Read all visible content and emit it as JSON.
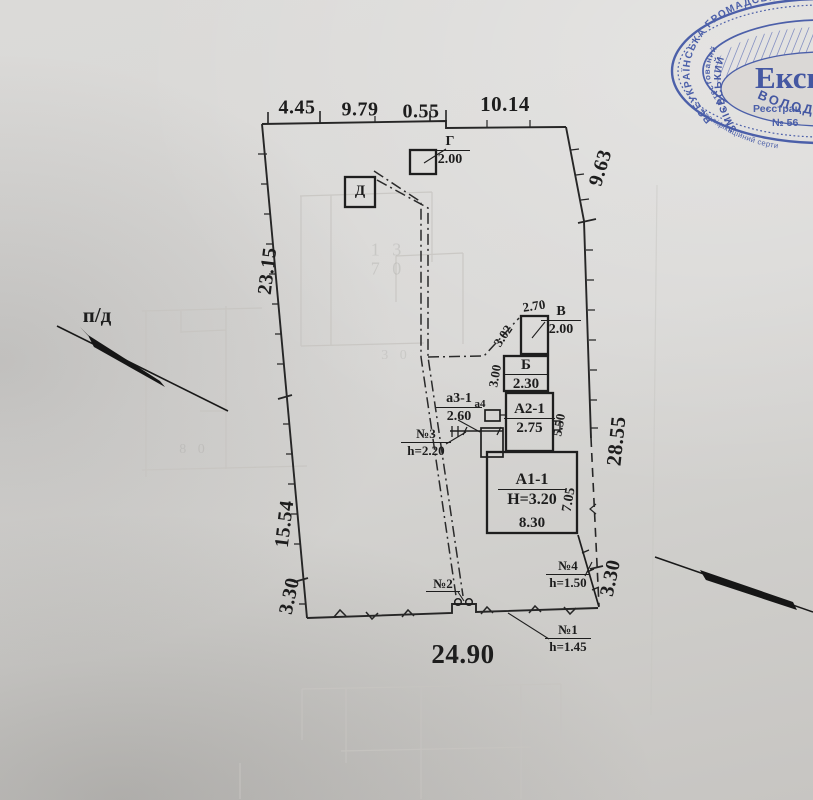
{
  "document": {
    "type_note": "scanned cadastral site plan",
    "ink_color": "#1d1d1d",
    "paper_color": "#d8d7d5"
  },
  "dimensions": {
    "top": [
      "4.45",
      "9.79",
      "0.55",
      "10.14"
    ],
    "left": [
      "23.15",
      "15.54",
      "3.30"
    ],
    "right": [
      "9.63",
      "28.55",
      "3.30"
    ],
    "bottom": "24.90"
  },
  "labels": {
    "direction": "п/д"
  },
  "buildings": {
    "g": {
      "lit": "Г",
      "h": "2.00"
    },
    "d": {
      "lit": "Д"
    },
    "v": {
      "lit": "В",
      "h": "2.00"
    },
    "b": {
      "lit": "Б",
      "h": "2.30"
    },
    "a21": {
      "lit": "А2-1",
      "h": "2.75"
    },
    "a11": {
      "lit": "А1-1",
      "h": "Н=3.20"
    },
    "a31": {
      "lit": "а3-1",
      "h": "2.60"
    },
    "a4": {
      "lit": "а4"
    }
  },
  "sizes": {
    "v_top": "2.70",
    "v_wall": "3.02",
    "b_wall": "3.00",
    "a21_wall": "5.50",
    "a11_wall": "7.05",
    "a11_width": "8.30"
  },
  "fences": {
    "n1": {
      "no": "№1",
      "h": "h=1.45"
    },
    "n2": {
      "no": "№2"
    },
    "n3": {
      "no": "№3",
      "h": "h=2.20"
    },
    "n4": {
      "no": "№4",
      "h": "h=1.50"
    }
  },
  "bleed": {
    "b1": "1 3",
    "b2": "7 0",
    "b3": "3 0",
    "b4": "8 0"
  },
  "stamp": {
    "color": "#3b51a3",
    "name_big": "Експ",
    "reg_label": "Реєстрац",
    "reg_number": "№ 56",
    "ring_outer": "ВСЕУКРАЇНСЬКА ГРОМАДСЬКА",
    "ring_attested": "• Атестований",
    "ring_surname": "ЗМІЄВСЬКИЙ",
    "ring_firstname": "ВОЛОД",
    "ring_cert": "Кваліфікаційний серти"
  }
}
